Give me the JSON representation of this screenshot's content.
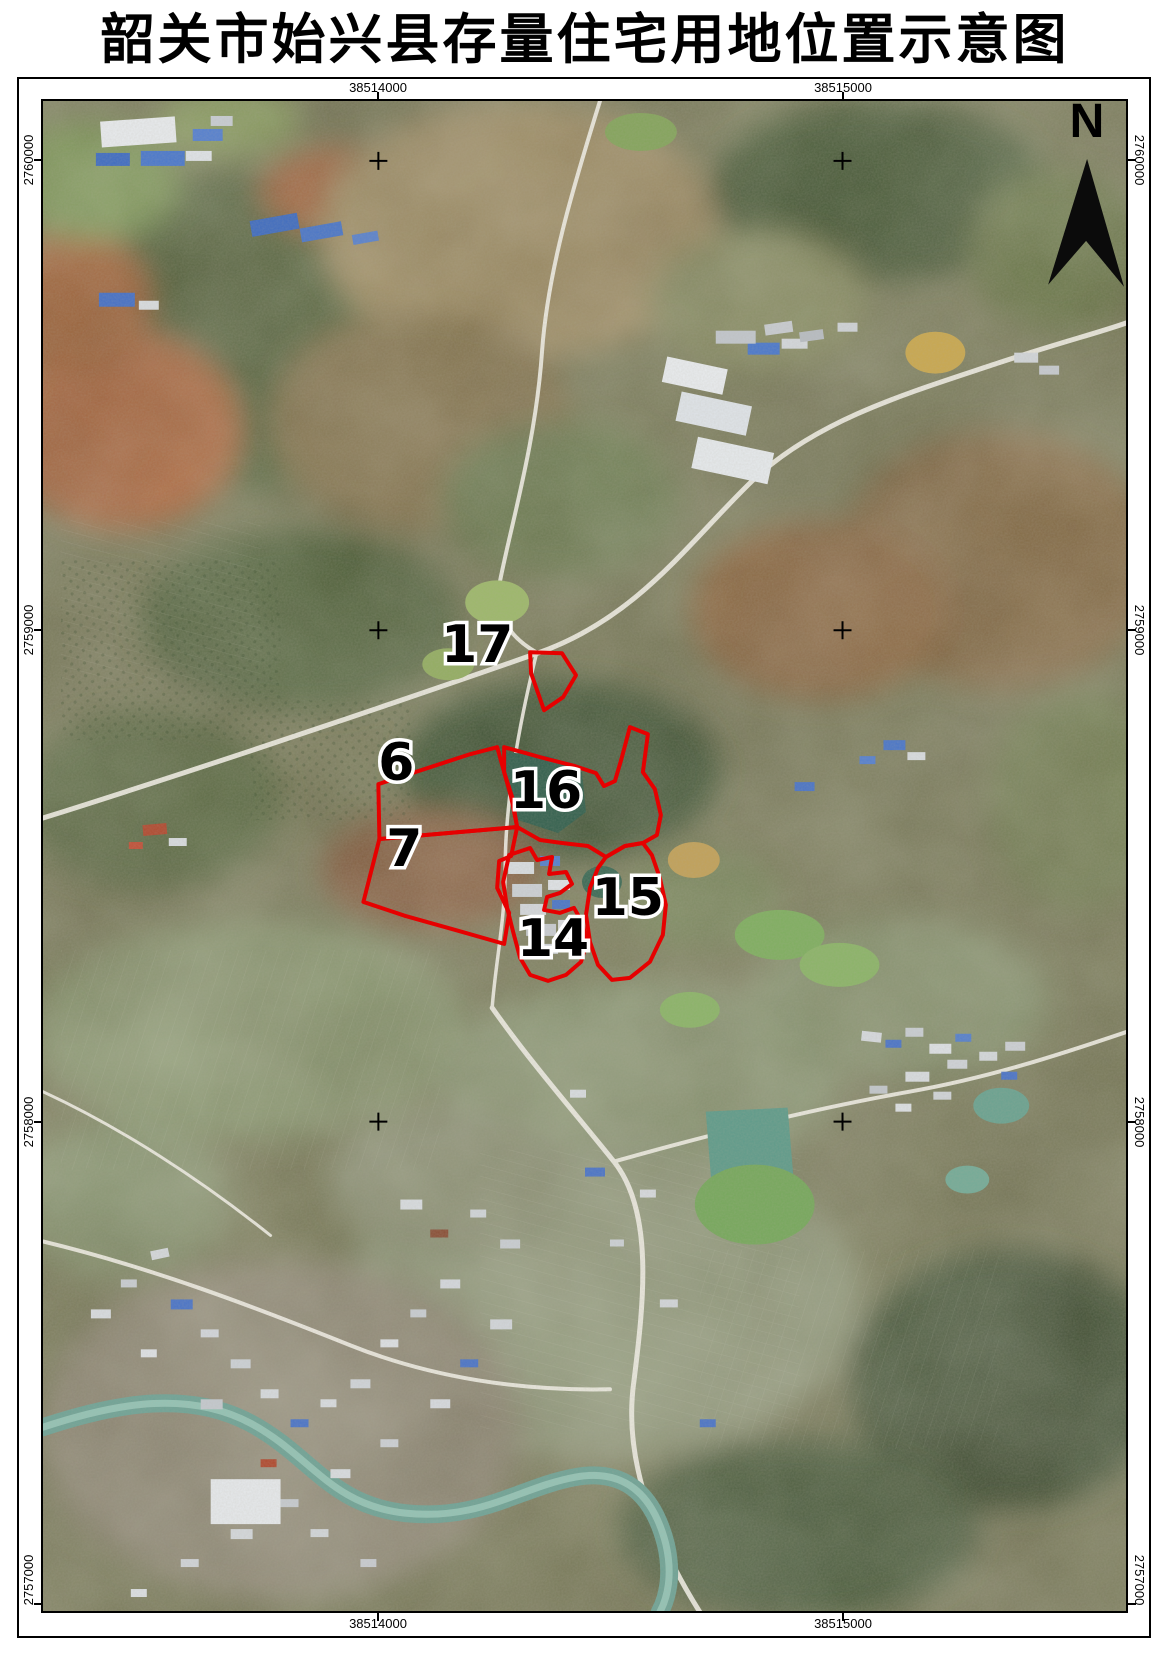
{
  "title": "韶关市始兴县存量住宅用地位置示意图",
  "north": {
    "label": "N"
  },
  "grid": {
    "x_labels": [
      {
        "text": "38514000",
        "x": 378
      },
      {
        "text": "38515000",
        "x": 843
      }
    ],
    "y_labels": [
      {
        "text": "2760000",
        "y": 160
      },
      {
        "text": "2759000",
        "y": 630
      },
      {
        "text": "2758000",
        "y": 1122
      },
      {
        "text": "2757000",
        "y": 1604
      }
    ]
  },
  "parcels": [
    {
      "id": "17",
      "label": {
        "x": 477,
        "y": 662
      },
      "points": "530,652 562,653 576,675 563,697 544,710 531,673"
    },
    {
      "id": "6",
      "label": {
        "x": 396,
        "y": 780
      },
      "points": "378,784 470,754 497,747 504,772 512,797 517,827 379,839"
    },
    {
      "id": "7",
      "label": {
        "x": 404,
        "y": 866
      },
      "points": "379,839 517,827 511,856 499,861 497,888 509,913 504,944 455,930 405,916 363,902"
    },
    {
      "id": "16",
      "label": {
        "x": 546,
        "y": 808
      },
      "points": "504,747 540,757 575,766 596,773 604,786 615,781 622,757 630,727 648,734 643,772 655,789 661,815 657,835 643,843 625,846 606,857 588,846 562,843 540,840 517,827 511,797 504,772"
    },
    {
      "id": "15",
      "label": {
        "x": 628,
        "y": 915
      },
      "points": "606,857 625,846 643,843 652,855 660,878 666,905 663,935 650,962 630,978 612,980 598,965 590,942 586,915 590,888 598,868"
    },
    {
      "id": "14",
      "label": {
        "x": 553,
        "y": 956
      },
      "points": "509,855 530,848 537,860 552,857 549,874 566,872 572,884 560,893 547,897 544,910 560,913 574,908 582,922 587,942 581,962 566,975 548,981 530,975 520,958 513,932 507,908 503,882"
    }
  ],
  "style": {
    "parcel_color": "#e60000",
    "label_color": "#000000",
    "halo_color": "#ffffff"
  }
}
